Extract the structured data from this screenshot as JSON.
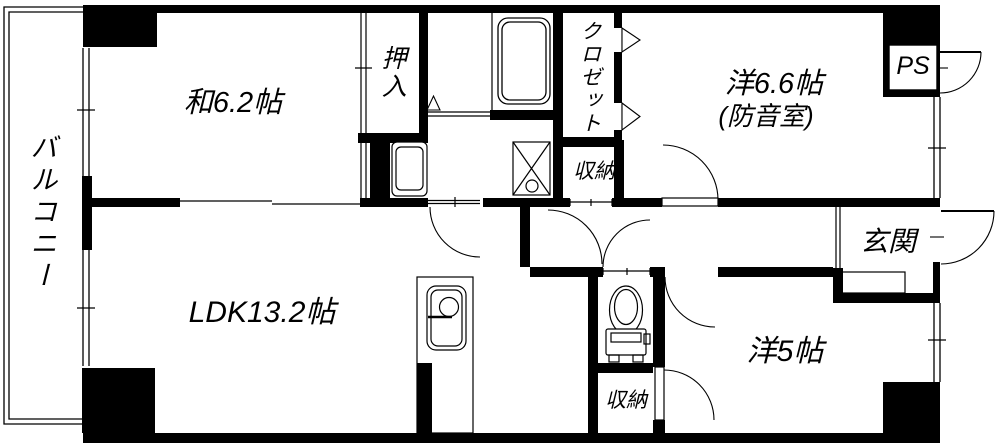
{
  "plan": {
    "background": "#ffffff",
    "line_color": "#000000",
    "labels": {
      "balcony": "バルコニー",
      "japanese_room": "和6.2帖",
      "oshiire_closet": "押入",
      "closet": "クロゼット",
      "storage_upper": "収納",
      "western_room_66": "洋6.6帖",
      "soundproof_note": "(防音室)",
      "pipe_space": "PS",
      "entrance": "玄関",
      "ldk": "LDK13.2帖",
      "storage_lower": "収納",
      "western_room_5": "洋5帖"
    }
  }
}
